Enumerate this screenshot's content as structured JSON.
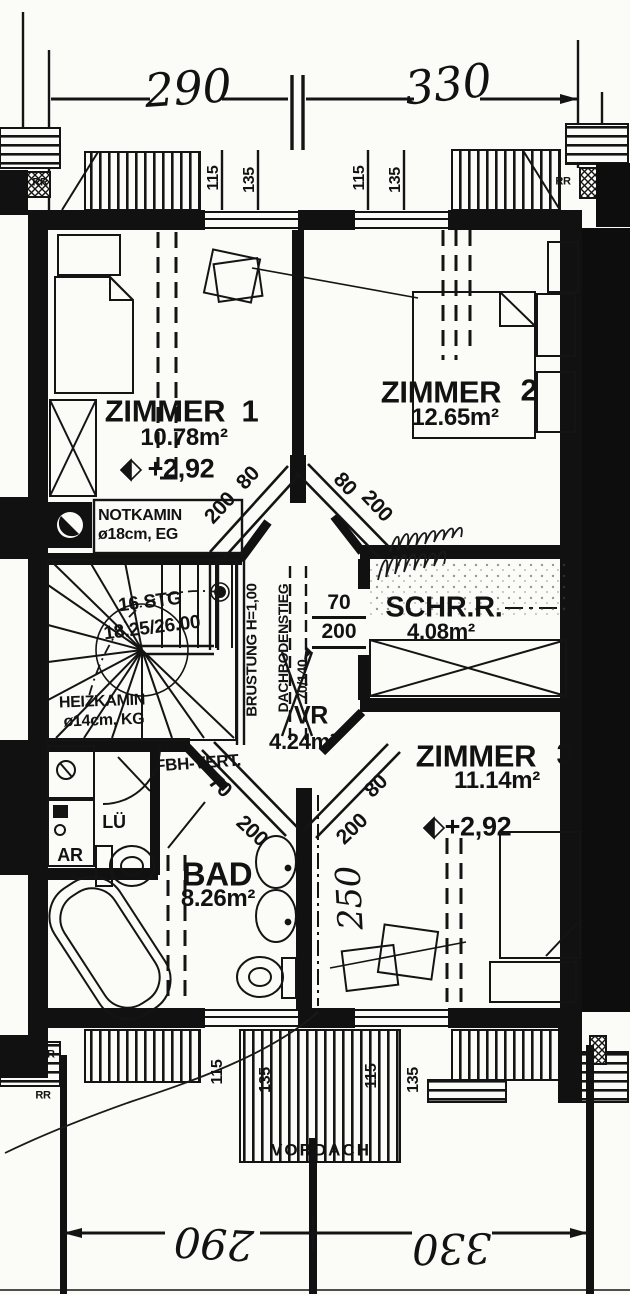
{
  "dimensions": {
    "top_left": "290",
    "top_right": "330",
    "bottom_left": "290",
    "bottom_right": "330",
    "window_sill": "115",
    "window_height": "135",
    "hand_note": "250"
  },
  "rooms": {
    "zimmer1": {
      "name": "ZIMMER",
      "number": "1",
      "area": "10.78m²",
      "level": "+2,92"
    },
    "zimmer2": {
      "name": "ZIMMER",
      "number": "2",
      "area": "12.65m²"
    },
    "zimmer3": {
      "name": "ZIMMER",
      "number": "3",
      "area": "11.14m²",
      "level": "+2,92"
    },
    "schrankraum": {
      "name": "SCHR.R.",
      "area": "4.08m²"
    },
    "vorraum": {
      "name": "VR",
      "area": "4.24m²"
    },
    "bad": {
      "name": "BAD",
      "area": "8.26m²"
    }
  },
  "doors": {
    "zimmer1": {
      "w": "80",
      "h": "200"
    },
    "zimmer2": {
      "w": "80",
      "h": "200"
    },
    "zimmer3": {
      "w": "80",
      "h": "200"
    },
    "bad": {
      "w": "70",
      "h": "200"
    },
    "schrankraum": {
      "w": "70",
      "h": "200"
    }
  },
  "annotations": {
    "notkamin1": "NOTKAMIN",
    "notkamin2": "ø18cm, EG",
    "heizkamin1": "HEIZKAMIN",
    "heizkamin2": "ø14cm, KG",
    "stairs1": "16 STG",
    "stairs2": "18.25/26.00",
    "bruestung": "BRÜSTUNG H=1,00",
    "dachbodenstieg": "DACHBODENSTIEG",
    "dachbodenstieg_dim": "70/140",
    "fbh": "FBH-VERT.",
    "lueftung": "LÜ",
    "abstellraum": "AR",
    "vordach": "VORDACH",
    "rr": "RR"
  }
}
